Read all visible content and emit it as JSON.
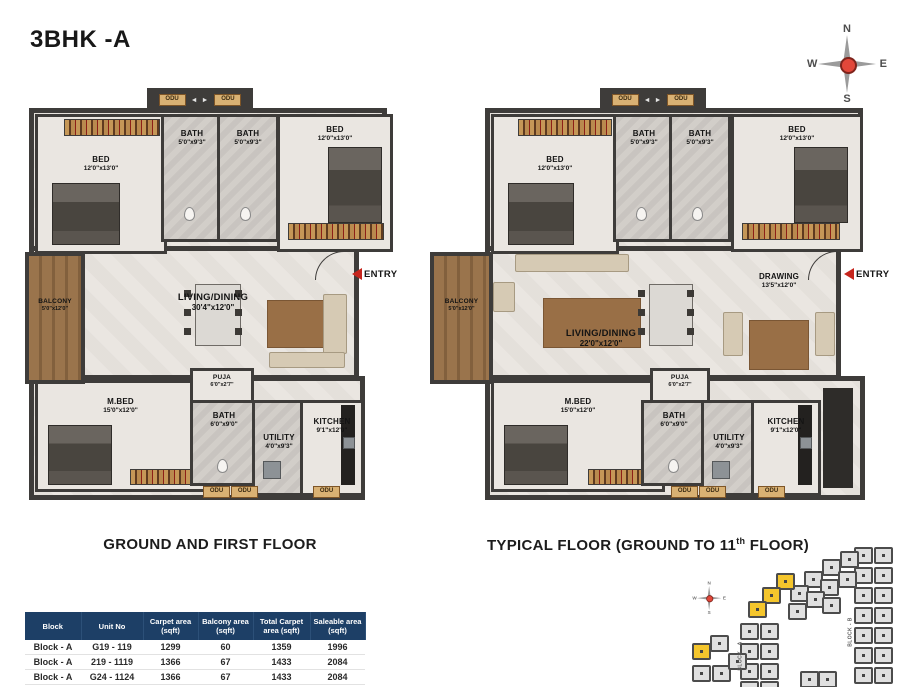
{
  "title": "3BHK -A",
  "compass": {
    "north": "N",
    "east": "E",
    "south": "S",
    "west": "W"
  },
  "labels": {
    "odu": "ODU",
    "entry": "ENTRY",
    "lift_arrows": "◄ ►"
  },
  "plans": {
    "left": {
      "caption": "GROUND AND FIRST FLOOR",
      "rooms": {
        "bed1": {
          "name": "BED",
          "dims": "12'0\"x13'0\""
        },
        "bath1": {
          "name": "BATH",
          "dims": "5'0\"x9'3\""
        },
        "bath2": {
          "name": "BATH",
          "dims": "5'0\"x9'3\""
        },
        "bed2": {
          "name": "BED",
          "dims": "12'0\"x13'0\""
        },
        "balcony": {
          "name": "BALCONY",
          "dims": "5'0\"x12'0\""
        },
        "living": {
          "name": "LIVING/DINING",
          "dims": "30'4\"x12'0\""
        },
        "mbed": {
          "name": "M.BED",
          "dims": "15'0\"x12'0\""
        },
        "puja": {
          "name": "PUJA",
          "dims": "6'0\"x2'7\""
        },
        "bath3": {
          "name": "BATH",
          "dims": "6'0\"x9'0\""
        },
        "utility": {
          "name": "UTILITY",
          "dims": "4'0\"x9'3\""
        },
        "kitchen": {
          "name": "KITCHEN",
          "dims": "9'1\"x12'0\""
        }
      }
    },
    "right": {
      "caption_pre": "TYPICAL FLOOR (GROUND TO 11",
      "caption_sup": "th",
      "caption_post": " FLOOR)",
      "rooms": {
        "bed1": {
          "name": "BED",
          "dims": "12'0\"x13'0\""
        },
        "bath1": {
          "name": "BATH",
          "dims": "5'0\"x9'3\""
        },
        "bath2": {
          "name": "BATH",
          "dims": "5'0\"x9'3\""
        },
        "bed2": {
          "name": "BED",
          "dims": "12'0\"x13'0\""
        },
        "balcony": {
          "name": "BALCONY",
          "dims": "5'0\"x12'0\""
        },
        "living": {
          "name": "LIVING/DINING",
          "dims": "22'0\"x12'0\""
        },
        "drawing": {
          "name": "DRAWING",
          "dims": "13'5\"x12'0\""
        },
        "mbed": {
          "name": "M.BED",
          "dims": "15'0\"x12'0\""
        },
        "puja": {
          "name": "PUJA",
          "dims": "6'0\"x2'7\""
        },
        "bath3": {
          "name": "BATH",
          "dims": "6'0\"x9'0\""
        },
        "utility": {
          "name": "UTILITY",
          "dims": "4'0\"x9'3\""
        },
        "kitchen": {
          "name": "KITCHEN",
          "dims": "9'1\"x12'0\""
        }
      }
    }
  },
  "table": {
    "headers": [
      "Block",
      "Unit No",
      "Carpet area\n(sqft)",
      "Balcony area\n(sqft)",
      "Total Carpet\narea (sqft)",
      "Saleable area\n(sqft)"
    ],
    "rows": [
      [
        "Block - A",
        "G19 - 119",
        "1299",
        "60",
        "1359",
        "1996"
      ],
      [
        "Block - A",
        "219 - 1119",
        "1366",
        "67",
        "1433",
        "2084"
      ],
      [
        "Block - A",
        "G24 - 1124",
        "1366",
        "67",
        "1433",
        "2084"
      ],
      [
        "Block - A",
        "",
        "",
        "",
        "",
        ""
      ]
    ]
  },
  "keyplan": {
    "block_a": "BLOCK - A",
    "block_b": "BLOCK - B",
    "unit_color": "#e0e0e0",
    "highlight_color": "#f5c62c",
    "units": [
      {
        "x": 172,
        "y": 2,
        "c": "g"
      },
      {
        "x": 192,
        "y": 2,
        "c": "g"
      },
      {
        "x": 172,
        "y": 22,
        "c": "g"
      },
      {
        "x": 192,
        "y": 22,
        "c": "g"
      },
      {
        "x": 172,
        "y": 42,
        "c": "g"
      },
      {
        "x": 192,
        "y": 42,
        "c": "g"
      },
      {
        "x": 172,
        "y": 62,
        "c": "g"
      },
      {
        "x": 192,
        "y": 62,
        "c": "g"
      },
      {
        "x": 172,
        "y": 82,
        "c": "g"
      },
      {
        "x": 192,
        "y": 82,
        "c": "g"
      },
      {
        "x": 172,
        "y": 102,
        "c": "g"
      },
      {
        "x": 192,
        "y": 102,
        "c": "g"
      },
      {
        "x": 172,
        "y": 122,
        "c": "g"
      },
      {
        "x": 192,
        "y": 122,
        "c": "g"
      },
      {
        "x": 158,
        "y": 6,
        "c": "g"
      },
      {
        "x": 140,
        "y": 14,
        "c": "g"
      },
      {
        "x": 156,
        "y": 26,
        "c": "g"
      },
      {
        "x": 122,
        "y": 26,
        "c": "g"
      },
      {
        "x": 138,
        "y": 34,
        "c": "g"
      },
      {
        "x": 108,
        "y": 40,
        "c": "g"
      },
      {
        "x": 124,
        "y": 46,
        "c": "g"
      },
      {
        "x": 140,
        "y": 52,
        "c": "g"
      },
      {
        "x": 94,
        "y": 28,
        "c": "y"
      },
      {
        "x": 80,
        "y": 42,
        "c": "y"
      },
      {
        "x": 66,
        "y": 56,
        "c": "y"
      },
      {
        "x": 106,
        "y": 58,
        "c": "g"
      },
      {
        "x": 58,
        "y": 78,
        "c": "g"
      },
      {
        "x": 78,
        "y": 78,
        "c": "g"
      },
      {
        "x": 58,
        "y": 98,
        "c": "g"
      },
      {
        "x": 78,
        "y": 98,
        "c": "g"
      },
      {
        "x": 58,
        "y": 118,
        "c": "g"
      },
      {
        "x": 78,
        "y": 118,
        "c": "g"
      },
      {
        "x": 58,
        "y": 136,
        "c": "g"
      },
      {
        "x": 78,
        "y": 136,
        "c": "g"
      },
      {
        "x": 10,
        "y": 98,
        "c": "y"
      },
      {
        "x": 28,
        "y": 90,
        "c": "g"
      },
      {
        "x": 10,
        "y": 120,
        "c": "g"
      },
      {
        "x": 30,
        "y": 120,
        "c": "g"
      },
      {
        "x": 46,
        "y": 108,
        "c": "g"
      },
      {
        "x": 118,
        "y": 126,
        "c": "g"
      },
      {
        "x": 136,
        "y": 126,
        "c": "g"
      }
    ]
  }
}
